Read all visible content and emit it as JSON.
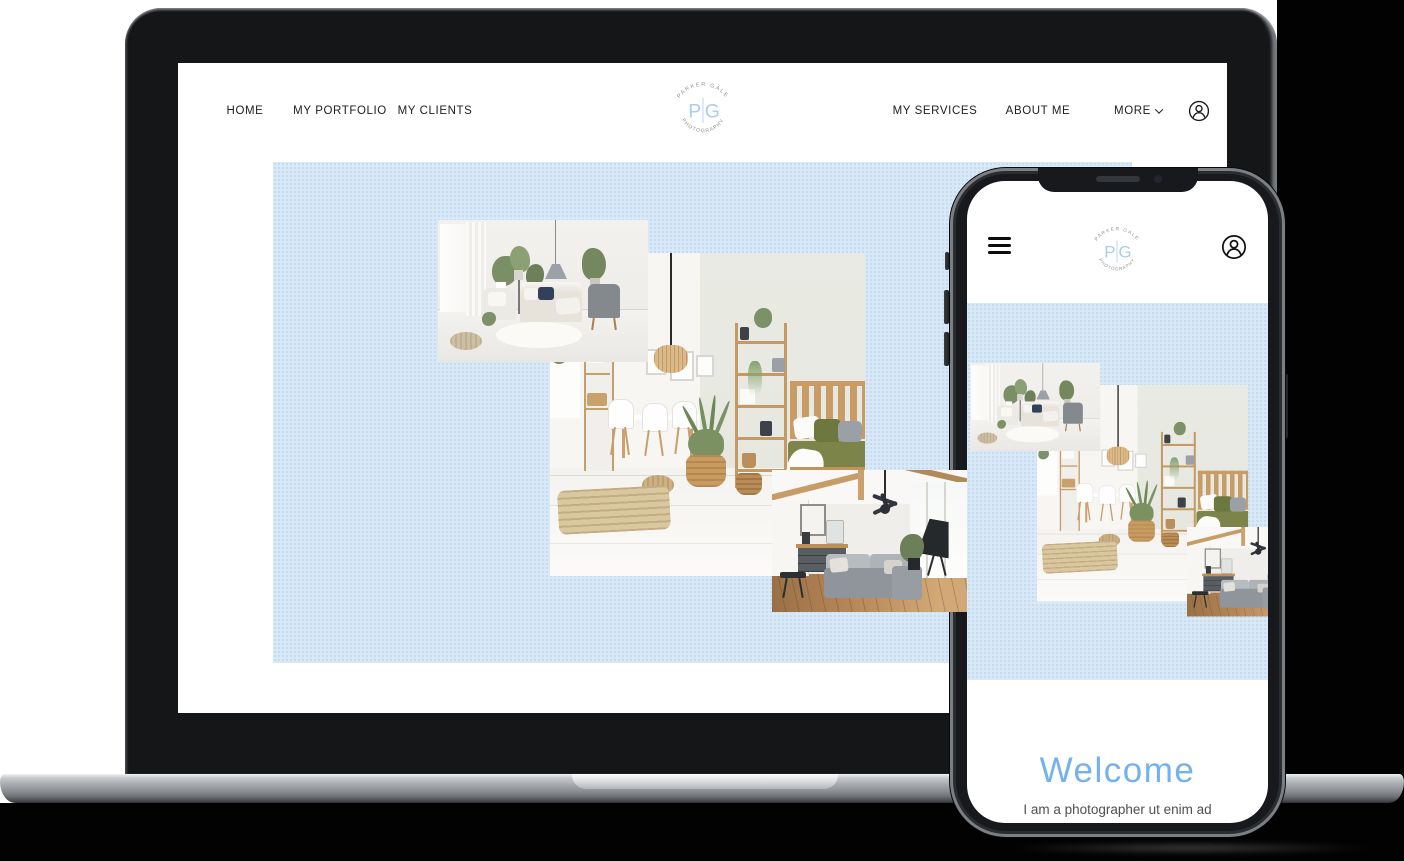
{
  "page": {
    "background_color": "#ffffff",
    "panel_color": "#020202",
    "hero_background": "#d7e8f7"
  },
  "brand": {
    "arc_top": "PARKER GALE",
    "arc_bottom": "PHOTOGRAPHY",
    "monogram_left": "P",
    "monogram_right": "G",
    "monogram_color": "#a9cdec"
  },
  "laptop_site": {
    "nav_left": [
      "HOME",
      "MY PORTFOLIO",
      "MY CLIENTS"
    ],
    "nav_right": [
      "MY SERVICES",
      "ABOUT ME"
    ],
    "more_label": "MORE",
    "icons": {
      "more_chevron": "chevron-down-icon",
      "account": "account-icon"
    },
    "hero_photos": [
      "bright-living-room",
      "scandi-dining-room",
      "loft-living-room"
    ]
  },
  "phone_site": {
    "icons": {
      "menu": "hamburger-menu-icon",
      "account": "account-icon"
    },
    "hero_photos": [
      "bright-living-room",
      "scandi-dining-room",
      "loft-living-room"
    ],
    "welcome_heading": "Welcome",
    "welcome_color": "#73b2ef",
    "intro_text": "I am a photographer ut enim ad"
  }
}
